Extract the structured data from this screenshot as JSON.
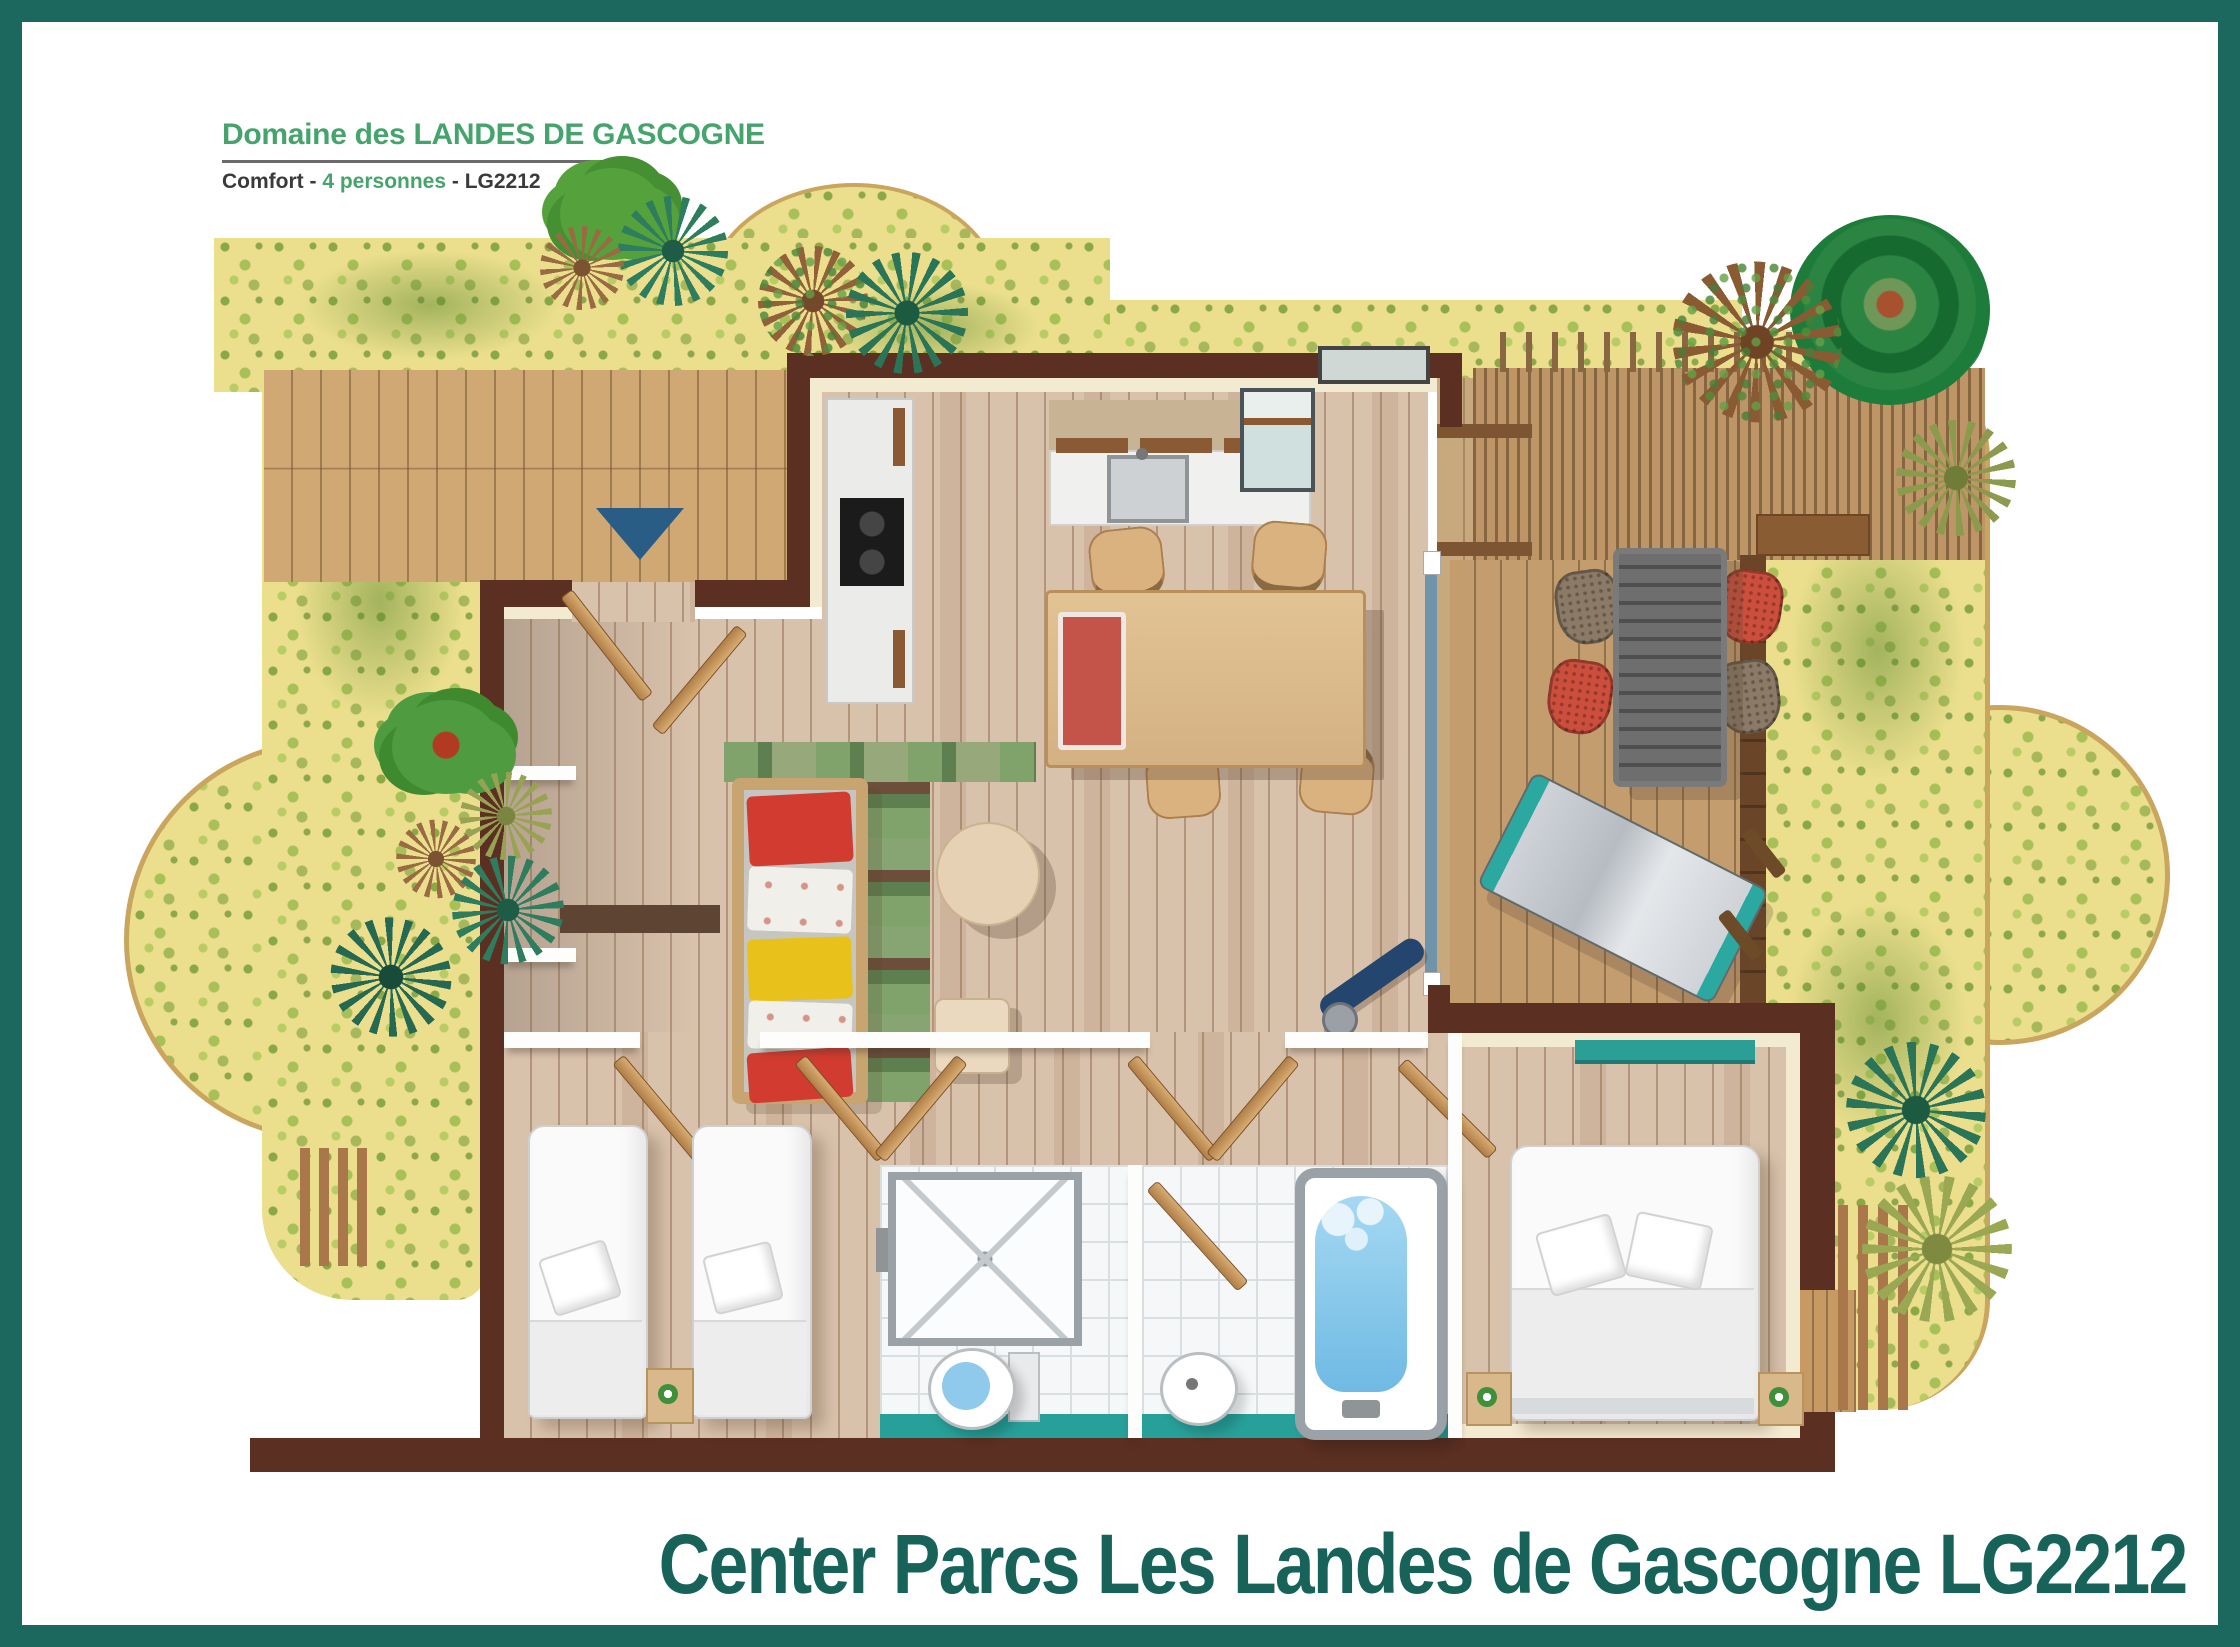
{
  "header": {
    "title": "Domaine des LANDES DE GASCOGNE",
    "subtitle": {
      "product": "Comfort",
      "separator": " - ",
      "capacity": "4 personnes",
      "code": "LG2212"
    }
  },
  "caption": {
    "text": "Center Parcs Les Landes de Gascogne LG2212"
  },
  "colors": {
    "frame_teal": "#1d685e",
    "title_green": "#45a46b",
    "subtitle_dark": "#3a3a3a",
    "caption_teal": "#17635a",
    "garden_yellow": "#ebdf8d",
    "garden_speckle_green": "#8fae3f",
    "garden_edge_tan": "#c9a55e",
    "deck_wood": "#cfa873",
    "terrace_wood": "#c49d6f",
    "wall_brown": "#5b2f22",
    "trim_cream": "#f3ead2",
    "floor_wood": "#d9c2ac",
    "bath_floor_teal": "#27a099",
    "water_blue": "#86c9ea",
    "cushion_red": "#d23b2f",
    "cushion_yellow": "#e8c21b",
    "hammock_teal": "#2ba8a0",
    "entrance_marker_blue": "#2a5d86"
  }
}
